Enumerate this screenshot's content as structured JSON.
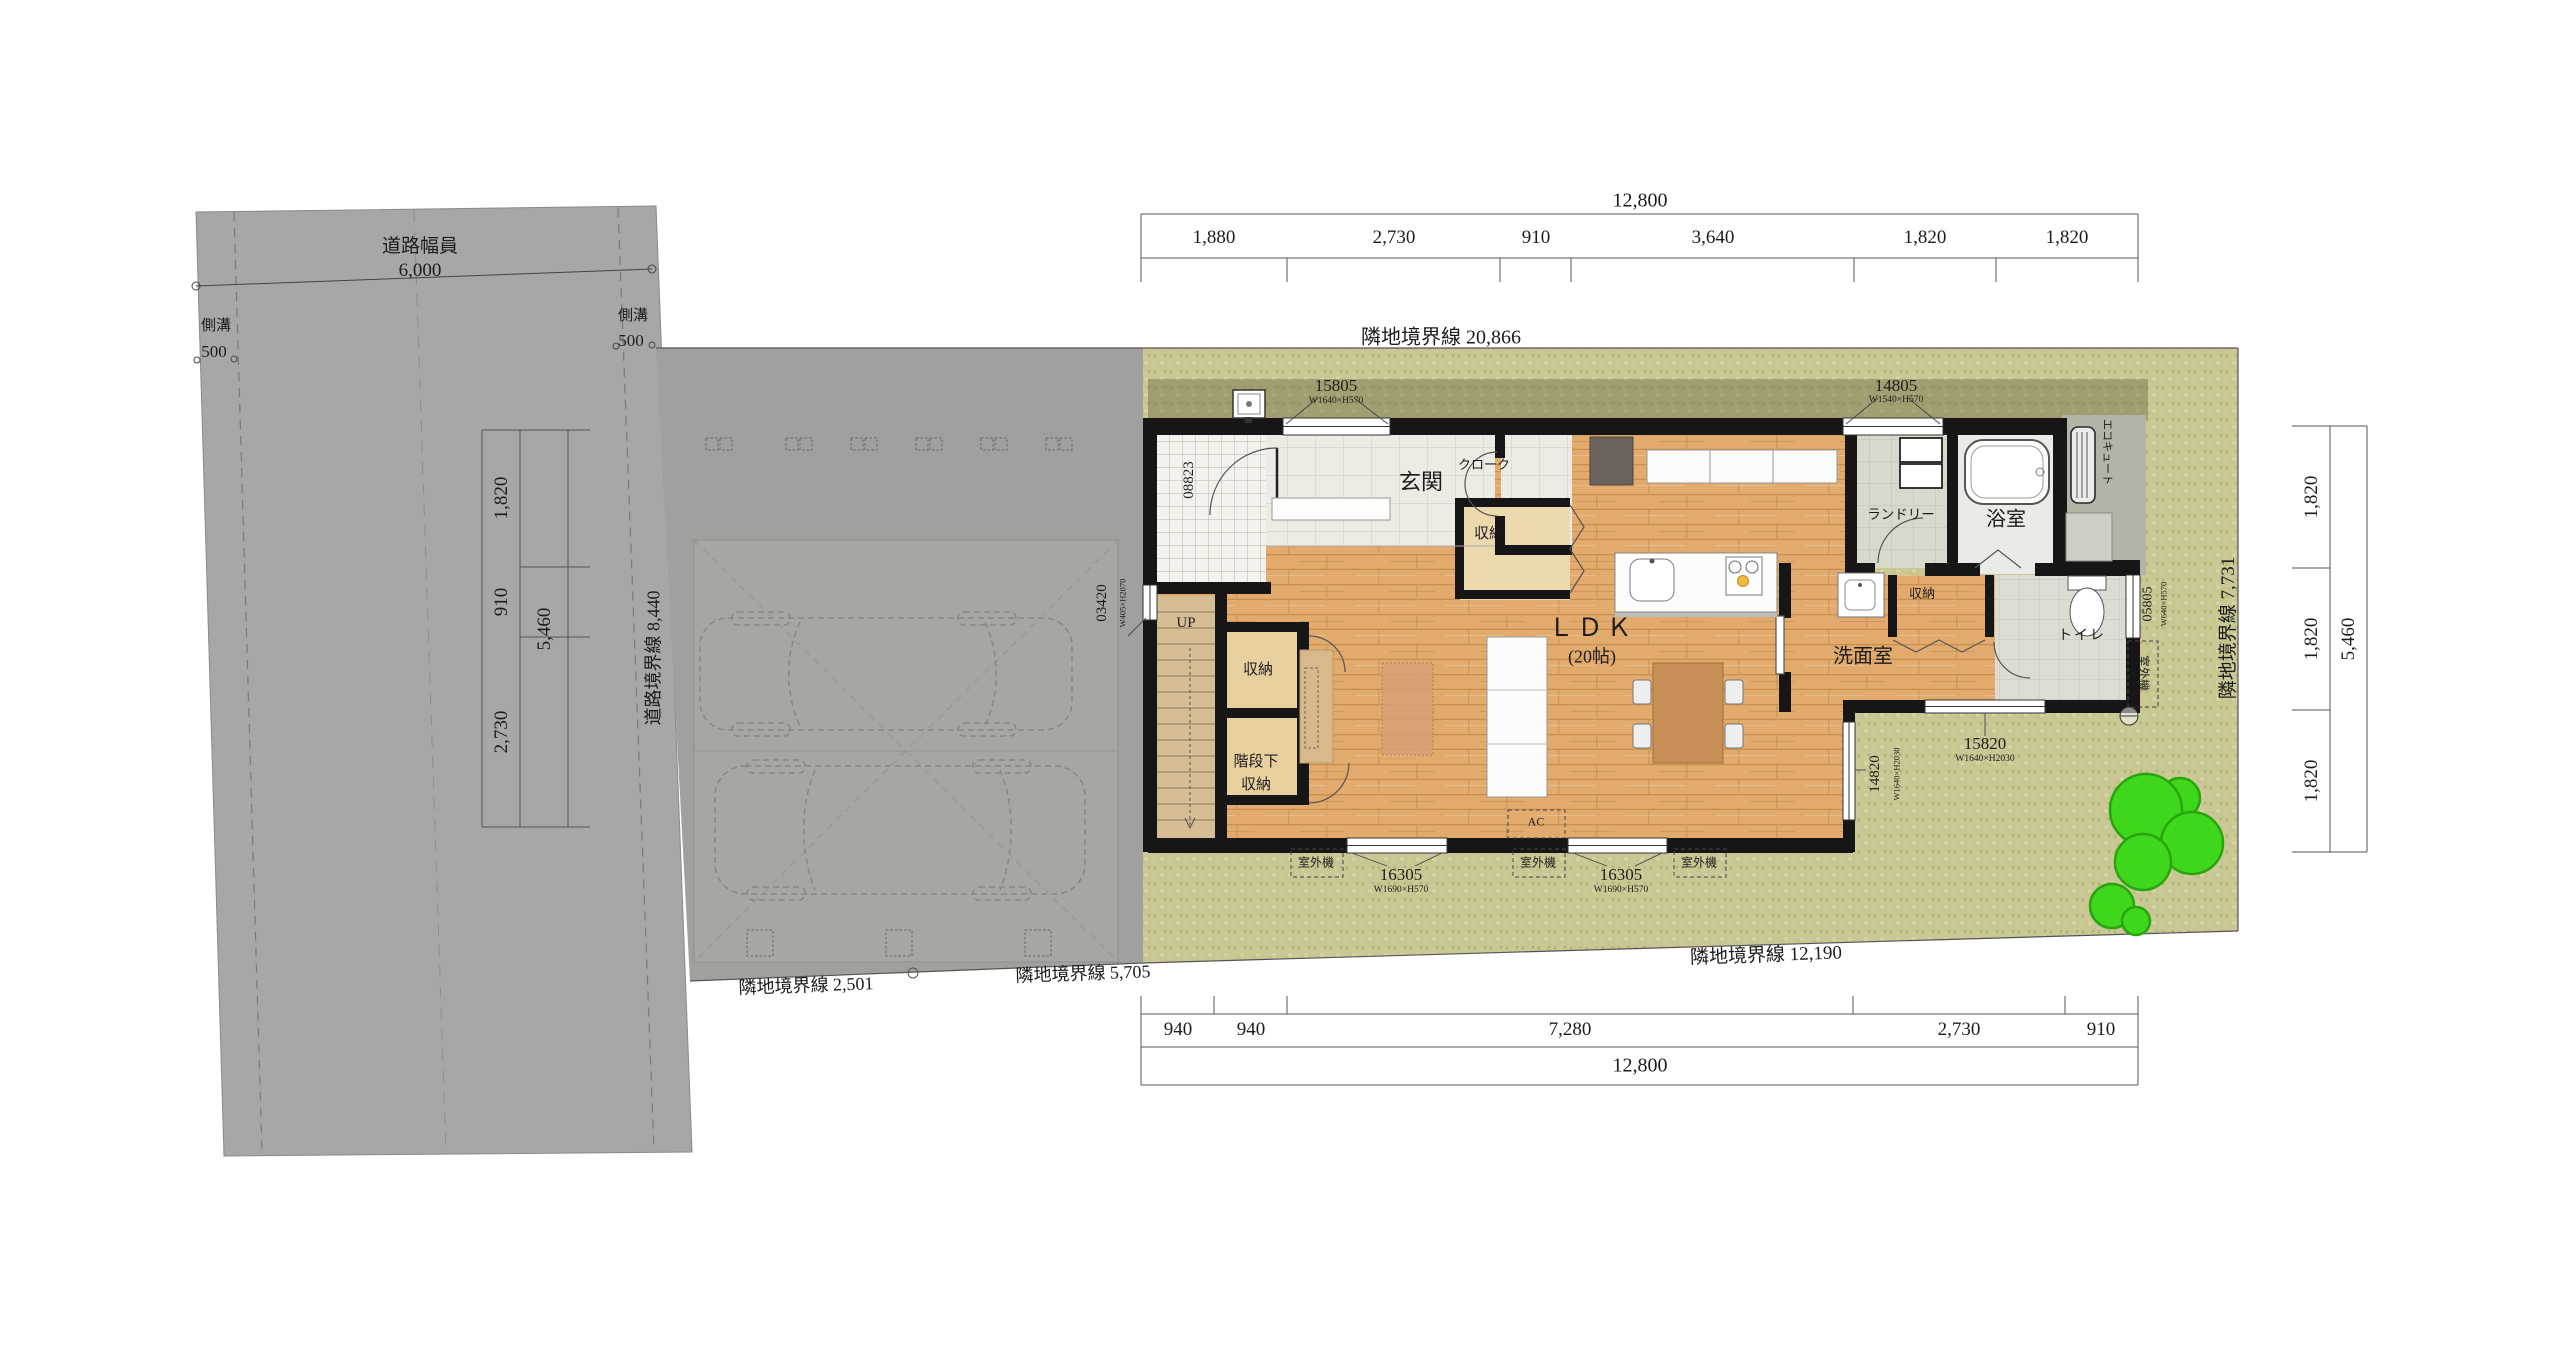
{
  "road": {
    "width_label": "道路幅員",
    "width_value": "6,000",
    "gutter_label": "側溝",
    "gutter_value": "500",
    "boundary_label": "道路境界線",
    "boundary_value": "8,440"
  },
  "boundaries": {
    "north": {
      "label": "隣地境界線",
      "value": "20,866"
    },
    "south": {
      "label": "隣地境界線",
      "value": "12,190"
    },
    "east": {
      "label": "隣地境界線",
      "value": "7,731"
    },
    "southwest_1": {
      "label": "隣地境界線",
      "value": "2,501"
    },
    "southwest_2": {
      "label": "隣地境界線",
      "value": "5,705"
    }
  },
  "dimensions": {
    "top": {
      "total": "12,800",
      "segments": [
        "1,880",
        "2,730",
        "910",
        "3,640",
        "1,820",
        "1,820"
      ]
    },
    "bottom": {
      "total": "12,800",
      "segments": [
        "940",
        "940",
        "7,280",
        "2,730",
        "910"
      ]
    },
    "right": {
      "total": "5,460",
      "segments": [
        "1,820",
        "1,820",
        "1,820"
      ]
    },
    "left": {
      "total": "5,460",
      "segments": [
        "1,820",
        "910",
        "2,730"
      ]
    }
  },
  "rooms": {
    "entrance": "玄関",
    "cloak": "クローク",
    "storage": "収納",
    "ldk": "ＬＤＫ",
    "ldk_size": "(20帖)",
    "under_stair_storage_line1": "階段下",
    "under_stair_storage_line2": "収納",
    "laundry": "ランドリー",
    "bathroom": "浴室",
    "washroom": "洗面室",
    "toilet": "トイレ",
    "stairs_up": "UP"
  },
  "openings": {
    "w15805": {
      "id": "15805",
      "size": "W1640×H570"
    },
    "w14805": {
      "id": "14805",
      "size": "W1540×H570"
    },
    "w16305": {
      "id": "16305",
      "size": "W1690×H570"
    },
    "w15820": {
      "id": "15820",
      "size": "W1640×H2030"
    },
    "w14820": {
      "id": "14820",
      "size": "W1640×H2030"
    },
    "w03420": {
      "id": "03420",
      "size": "W405×H2070"
    },
    "w05805": {
      "id": "05805",
      "size": "W640×H570"
    },
    "d08823": {
      "id": "08823"
    }
  },
  "equipment": {
    "outdoor_unit": "室外機",
    "ac": "AC",
    "ecocute": "エコキュート"
  }
}
